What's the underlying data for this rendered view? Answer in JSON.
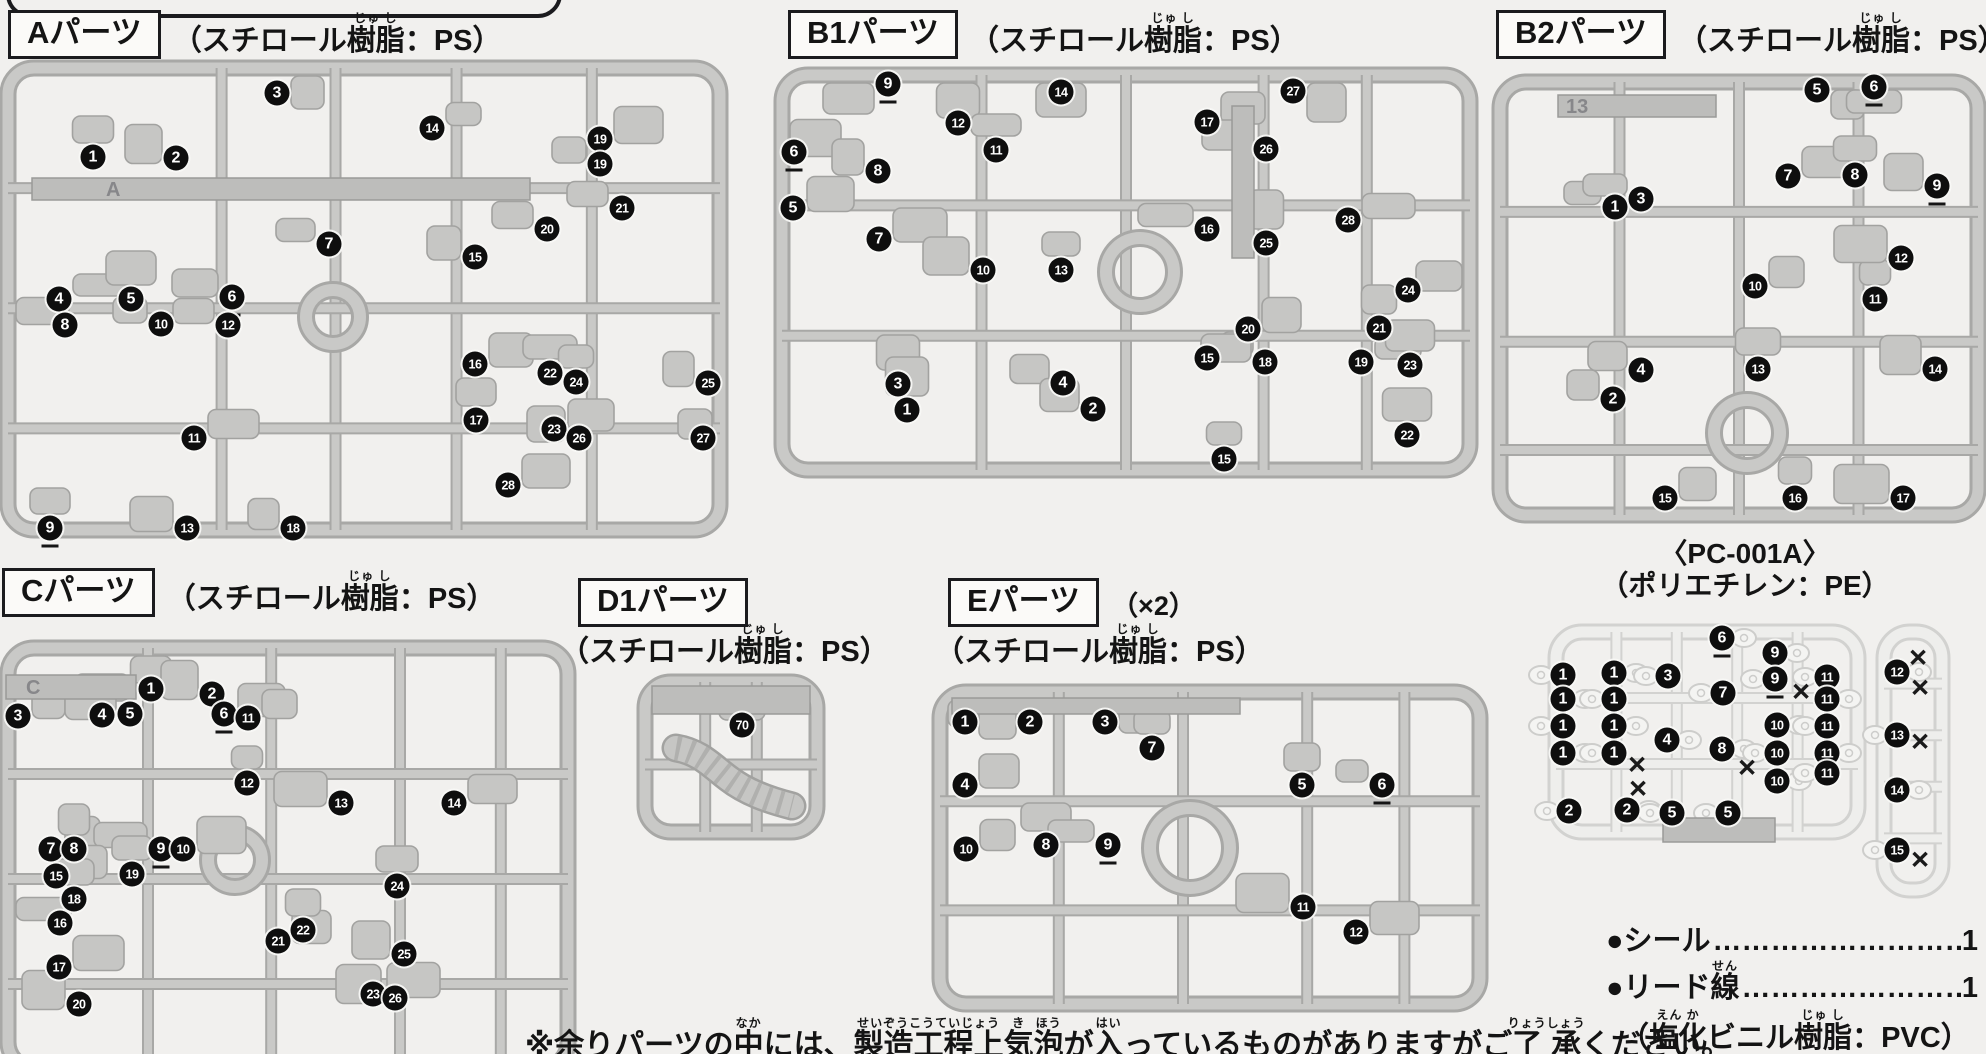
{
  "page": {
    "bg": "#f1f0ee"
  },
  "materials": {
    "ps": [
      [
        "（スチロール",
        null
      ],
      [
        "樹脂",
        "じゅ し"
      ],
      [
        "：PS）",
        null
      ]
    ],
    "pe": [
      [
        "（ポリエチレン：PE）",
        null
      ]
    ],
    "pvc": [
      [
        "（",
        null
      ],
      [
        "塩化",
        "えん か"
      ],
      [
        "ビニル",
        null
      ],
      [
        "樹脂",
        "じゅ し"
      ],
      [
        "：PVC）",
        null
      ]
    ]
  },
  "headers": [
    {
      "id": "a",
      "label": "Aパーツ",
      "material": "ps",
      "x": 8,
      "y": 10,
      "inline": true
    },
    {
      "id": "b1",
      "label": "B1パーツ",
      "material": "ps",
      "x": 788,
      "y": 10,
      "inline": true
    },
    {
      "id": "b2",
      "label": "B2パーツ",
      "material": "ps",
      "x": 1496,
      "y": 10,
      "inline": true
    },
    {
      "id": "c",
      "label": "Cパーツ",
      "material": "ps",
      "x": 2,
      "y": 568,
      "inline": true
    },
    {
      "id": "d1",
      "label": "D1パーツ",
      "material": "ps",
      "x": 578,
      "y": 578,
      "inline": false,
      "mx": 560,
      "my": 622
    },
    {
      "id": "e",
      "label": "Eパーツ",
      "suffix": "（×2）",
      "material": "ps",
      "x": 948,
      "y": 578,
      "inline": false,
      "mx": 935,
      "my": 622
    }
  ],
  "pc_header": {
    "line1": "〈PC-001A〉",
    "material": "pe",
    "x": 1745,
    "y": 538
  },
  "accessories": {
    "x": 1606,
    "y": 924,
    "lines": [
      {
        "segs": [
          [
            "●シール",
            null
          ]
        ],
        "dots": "………………………………",
        "count": "1"
      },
      {
        "segs": [
          [
            "●リード",
            null
          ],
          [
            "線",
            "せん"
          ]
        ],
        "dots": "………………………………",
        "count": "1"
      }
    ],
    "note_material": "pvc"
  },
  "caution": {
    "x": 525,
    "y": 1016,
    "segs": [
      [
        "※余りパーツの",
        null
      ],
      [
        "中",
        "なか"
      ],
      [
        "には、",
        null
      ],
      [
        "製造工程上",
        "せいぞうこうていじょう"
      ],
      [
        "気",
        "き"
      ],
      [
        "泡",
        "ほう"
      ],
      [
        "が",
        null
      ],
      [
        "入",
        "はい"
      ],
      [
        "っているものがありますがご",
        null
      ],
      [
        "了承",
        "りょうしょう"
      ],
      [
        "ください。",
        null
      ]
    ]
  },
  "cutoff_box": {
    "x": 6,
    "y": -30,
    "w": 548,
    "h": 40
  },
  "runners": [
    {
      "id": "runner-a",
      "frames": [
        {
          "r": [
            8,
            68,
            712,
            462
          ],
          "v": [
            0.3,
            0.46,
            0.63,
            0.82
          ],
          "h": [
            0.26,
            0.52,
            0.78
          ]
        }
      ],
      "ring": [
        333,
        317,
        27
      ],
      "plates": [
        {
          "r": [
            32,
            178,
            498,
            22
          ],
          "label": "A",
          "lx": 106,
          "ly": 196
        }
      ],
      "badges": [
        [
          1,
          93,
          157
        ],
        [
          2,
          176,
          158
        ],
        [
          3,
          277,
          93
        ],
        [
          14,
          432,
          128
        ],
        [
          19,
          600,
          139
        ],
        [
          19,
          600,
          164
        ],
        [
          21,
          622,
          208
        ],
        [
          20,
          547,
          229
        ],
        [
          7,
          329,
          244
        ],
        [
          15,
          475,
          257
        ],
        [
          4,
          59,
          299
        ],
        [
          5,
          131,
          299
        ],
        [
          6,
          232,
          297,
          "u"
        ],
        [
          8,
          65,
          325
        ],
        [
          10,
          161,
          324
        ],
        [
          12,
          228,
          325
        ],
        [
          16,
          475,
          364
        ],
        [
          17,
          476,
          420
        ],
        [
          22,
          550,
          373
        ],
        [
          24,
          576,
          382
        ],
        [
          25,
          708,
          383
        ],
        [
          23,
          554,
          429
        ],
        [
          26,
          579,
          438
        ],
        [
          27,
          703,
          438
        ],
        [
          11,
          194,
          438
        ],
        [
          9,
          50,
          528,
          "u"
        ],
        [
          13,
          187,
          528
        ],
        [
          18,
          293,
          528
        ],
        [
          28,
          508,
          485
        ]
      ],
      "crosses": []
    },
    {
      "id": "runner-b1",
      "frames": [
        {
          "r": [
            782,
            75,
            688,
            395
          ],
          "v": [
            0.29,
            0.5,
            0.7,
            0.85
          ],
          "h": [
            0.33,
            0.66
          ]
        }
      ],
      "ring": [
        1140,
        272,
        34
      ],
      "plates": [
        {
          "r": [
            1232,
            106,
            22,
            152
          ]
        }
      ],
      "badges": [
        [
          9,
          888,
          84,
          "u"
        ],
        [
          12,
          958,
          123
        ],
        [
          14,
          1061,
          92
        ],
        [
          6,
          794,
          152,
          "u"
        ],
        [
          8,
          878,
          171
        ],
        [
          11,
          996,
          150
        ],
        [
          5,
          793,
          208
        ],
        [
          7,
          879,
          239
        ],
        [
          10,
          983,
          270
        ],
        [
          13,
          1061,
          270
        ],
        [
          3,
          898,
          384
        ],
        [
          4,
          1063,
          383
        ],
        [
          1,
          907,
          410
        ],
        [
          2,
          1093,
          409
        ],
        [
          27,
          1293,
          91
        ],
        [
          17,
          1207,
          122
        ],
        [
          26,
          1266,
          149
        ],
        [
          16,
          1207,
          229
        ],
        [
          25,
          1266,
          243
        ],
        [
          28,
          1348,
          220
        ],
        [
          24,
          1408,
          290
        ],
        [
          20,
          1248,
          329
        ],
        [
          21,
          1379,
          328
        ],
        [
          15,
          1207,
          358
        ],
        [
          18,
          1265,
          362
        ],
        [
          19,
          1361,
          362
        ],
        [
          23,
          1410,
          365
        ],
        [
          22,
          1407,
          435
        ],
        [
          15,
          1224,
          459
        ]
      ],
      "crosses": []
    },
    {
      "id": "runner-b2",
      "frames": [
        {
          "r": [
            1500,
            82,
            478,
            433
          ],
          "v": [
            0.25,
            0.5,
            0.75
          ],
          "h": [
            0.3,
            0.6,
            0.85
          ]
        }
      ],
      "ring": [
        1747,
        433,
        33
      ],
      "plates": [
        {
          "r": [
            1558,
            95,
            158,
            22
          ],
          "label": "13",
          "lx": 1566,
          "ly": 113
        }
      ],
      "badges": [
        [
          5,
          1817,
          90
        ],
        [
          6,
          1874,
          87,
          "u"
        ],
        [
          1,
          1615,
          207
        ],
        [
          3,
          1641,
          199
        ],
        [
          7,
          1788,
          176
        ],
        [
          8,
          1855,
          175
        ],
        [
          9,
          1937,
          186,
          "u"
        ],
        [
          10,
          1755,
          286
        ],
        [
          11,
          1875,
          299
        ],
        [
          12,
          1901,
          258
        ],
        [
          2,
          1613,
          399
        ],
        [
          4,
          1641,
          370
        ],
        [
          13,
          1758,
          369
        ],
        [
          14,
          1935,
          369
        ],
        [
          15,
          1665,
          498
        ],
        [
          16,
          1795,
          498
        ],
        [
          17,
          1903,
          498
        ]
      ],
      "crosses": []
    },
    {
      "id": "runner-c",
      "frames": [
        {
          "r": [
            8,
            648,
            560,
            420
          ],
          "v": [
            0.25,
            0.47,
            0.7,
            0.88
          ],
          "h": [
            0.3,
            0.55,
            0.8
          ]
        }
      ],
      "ring": [
        235,
        860,
        27
      ],
      "plates": [
        {
          "r": [
            6,
            675,
            130,
            24
          ],
          "label": "C",
          "lx": 26,
          "ly": 694
        }
      ],
      "badges": [
        [
          1,
          151,
          689
        ],
        [
          2,
          212,
          694
        ],
        [
          3,
          18,
          716
        ],
        [
          4,
          102,
          715
        ],
        [
          5,
          130,
          714
        ],
        [
          6,
          224,
          714,
          "u"
        ],
        [
          11,
          248,
          718
        ],
        [
          12,
          247,
          783
        ],
        [
          13,
          341,
          803
        ],
        [
          14,
          454,
          803
        ],
        [
          7,
          51,
          849
        ],
        [
          8,
          74,
          849
        ],
        [
          9,
          161,
          849,
          "u"
        ],
        [
          10,
          183,
          849
        ],
        [
          15,
          56,
          876
        ],
        [
          19,
          132,
          874
        ],
        [
          18,
          74,
          899
        ],
        [
          16,
          60,
          923
        ],
        [
          17,
          59,
          967
        ],
        [
          20,
          79,
          1004
        ],
        [
          21,
          278,
          941
        ],
        [
          22,
          303,
          930
        ],
        [
          24,
          397,
          886
        ],
        [
          25,
          404,
          954
        ],
        [
          23,
          373,
          994
        ],
        [
          26,
          395,
          998
        ]
      ],
      "crosses": []
    },
    {
      "id": "runner-d1",
      "frames": [
        {
          "r": [
            645,
            682,
            172,
            150
          ],
          "v": [
            0.35,
            0.65
          ],
          "h": [
            0.55
          ]
        }
      ],
      "ring": null,
      "plates": [
        {
          "r": [
            652,
            686,
            158,
            28
          ]
        }
      ],
      "hose": "M676,748 C700,752 712,766 728,778 C746,792 768,800 792,806",
      "badges": [
        [
          70,
          742,
          725
        ]
      ],
      "crosses": []
    },
    {
      "id": "runner-e",
      "frames": [
        {
          "r": [
            940,
            692,
            540,
            312
          ],
          "v": [
            0.22,
            0.45,
            0.68,
            0.86
          ],
          "h": [
            0.35,
            0.7
          ]
        }
      ],
      "ring": [
        1190,
        848,
        40
      ],
      "plates": [
        {
          "r": [
            952,
            698,
            288,
            16
          ]
        }
      ],
      "badges": [
        [
          1,
          965,
          722
        ],
        [
          2,
          1030,
          722
        ],
        [
          3,
          1105,
          722
        ],
        [
          7,
          1152,
          748
        ],
        [
          4,
          965,
          785
        ],
        [
          5,
          1302,
          785
        ],
        [
          6,
          1382,
          785,
          "u"
        ],
        [
          10,
          966,
          849
        ],
        [
          8,
          1046,
          845
        ],
        [
          9,
          1108,
          845,
          "u"
        ],
        [
          11,
          1303,
          907
        ],
        [
          12,
          1356,
          932
        ]
      ],
      "crosses": []
    },
    {
      "id": "runner-pc",
      "light": true,
      "frames": [
        {
          "r": [
            1556,
            632,
            302,
            200
          ],
          "v": [
            0.2,
            0.4,
            0.6,
            0.8
          ],
          "h": [
            0.33,
            0.66
          ]
        },
        {
          "r": [
            1884,
            632,
            58,
            258
          ],
          "v": [],
          "h": [
            0.2,
            0.4,
            0.6,
            0.8
          ]
        }
      ],
      "ring": null,
      "plates": [
        {
          "r": [
            1663,
            818,
            112,
            24
          ]
        }
      ],
      "badges": [
        [
          1,
          1563,
          675
        ],
        [
          1,
          1563,
          699
        ],
        [
          1,
          1563,
          726
        ],
        [
          1,
          1563,
          753
        ],
        [
          2,
          1569,
          811
        ],
        [
          1,
          1614,
          673
        ],
        [
          1,
          1614,
          699
        ],
        [
          1,
          1614,
          726
        ],
        [
          1,
          1614,
          753
        ],
        [
          2,
          1627,
          810
        ],
        [
          3,
          1668,
          676
        ],
        [
          4,
          1667,
          740
        ],
        [
          5,
          1672,
          813
        ],
        [
          6,
          1722,
          638,
          "u"
        ],
        [
          7,
          1723,
          693
        ],
        [
          8,
          1722,
          749
        ],
        [
          5,
          1728,
          813
        ],
        [
          9,
          1775,
          653,
          "u"
        ],
        [
          9,
          1775,
          679,
          "u"
        ],
        [
          10,
          1777,
          725
        ],
        [
          10,
          1777,
          753
        ],
        [
          10,
          1777,
          781
        ],
        [
          11,
          1827,
          677
        ],
        [
          11,
          1827,
          699
        ],
        [
          11,
          1827,
          726
        ],
        [
          11,
          1827,
          753
        ],
        [
          11,
          1827,
          773
        ],
        [
          12,
          1897,
          672
        ],
        [
          13,
          1897,
          735
        ],
        [
          14,
          1897,
          790
        ],
        [
          15,
          1897,
          850
        ]
      ],
      "crosses": [
        [
          1637,
          764
        ],
        [
          1638,
          788
        ],
        [
          1747,
          767
        ],
        [
          1801,
          691
        ],
        [
          1918,
          657
        ],
        [
          1920,
          687
        ],
        [
          1920,
          741
        ],
        [
          1920,
          859
        ]
      ]
    }
  ]
}
